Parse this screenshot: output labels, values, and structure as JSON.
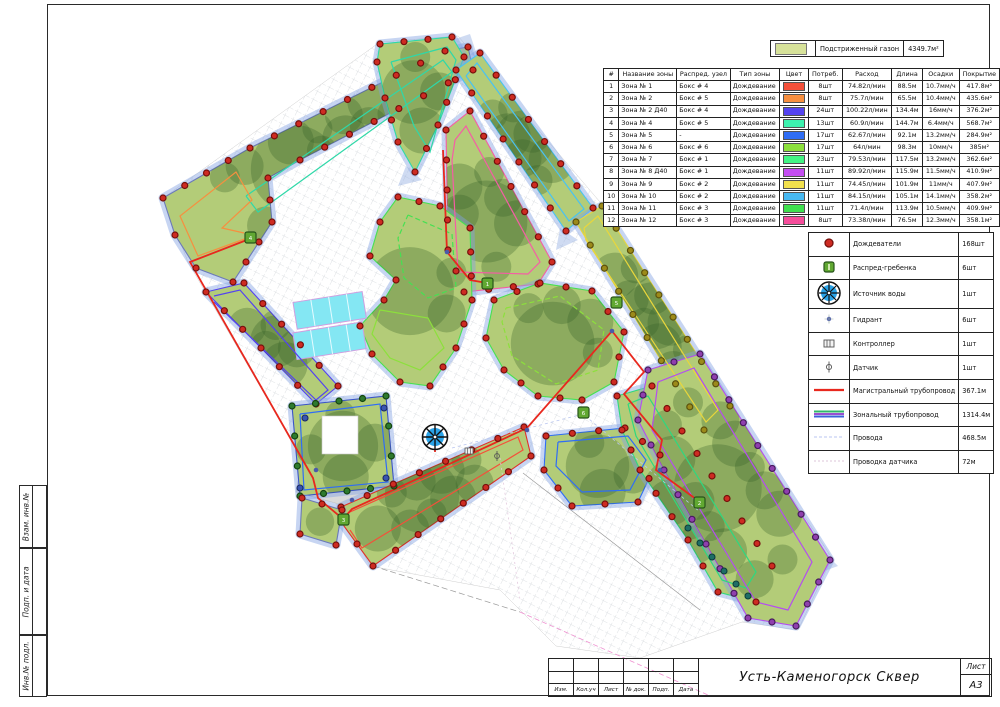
{
  "page": {
    "drawing_title": "Усть-Каменогорск Сквер",
    "sheet_label": "Лист",
    "sheet_format": "А3"
  },
  "stamp_columns": [
    "Изм.",
    "Кол.уч",
    "Лист",
    "№ док.",
    "Подп.",
    "Дата"
  ],
  "side_labels": [
    "Взам. инв.№",
    "Подп. и дата",
    "Инв.№ подл."
  ],
  "lawn_legend": {
    "label": "Подстриженный газон",
    "value": "4349.7м²",
    "color": "#d7e29a"
  },
  "zones_table": {
    "headers": [
      "#",
      "Название зоны",
      "Распред. узел",
      "Тип зоны",
      "Цвет",
      "Потреб.",
      "Расход",
      "Длина",
      "Осадки",
      "Покрытие"
    ],
    "rows": [
      [
        "1",
        "Зона № 1",
        "Бокс # 4",
        "Дождевание",
        "#f4503a",
        "8шт",
        "74.82л/мин",
        "88.5м",
        "10.7мм/ч",
        "417.8м²"
      ],
      [
        "2",
        "Зона № 2",
        "Бокс # 5",
        "Дождевание",
        "#f78f3f",
        "8шт",
        "75.7л/мин",
        "65.5м",
        "10.4мм/ч",
        "435.6м²"
      ],
      [
        "3",
        "Зона № 2 Д40",
        "Бокс # 4",
        "Дождевание",
        "#5443f0",
        "24шт",
        "100.22л/мин",
        "134.4м",
        "16мм/ч",
        "376.2м²"
      ],
      [
        "4",
        "Зона № 4",
        "Бокс # 5",
        "Дождевание",
        "#3df2af",
        "13шт",
        "60.9л/мин",
        "144.7м",
        "6.4мм/ч",
        "568.7м²"
      ],
      [
        "5",
        "Зона № 5",
        "-",
        "Дождевание",
        "#2f6df5",
        "17шт",
        "62.67л/мин",
        "92.1м",
        "13.2мм/ч",
        "284.9м²"
      ],
      [
        "6",
        "Зона № 6",
        "Бокс # 6",
        "Дождевание",
        "#8ce03c",
        "17шт",
        "64л/мин",
        "98.3м",
        "10мм/ч",
        "385м²"
      ],
      [
        "7",
        "Зона № 7",
        "Бокс # 1",
        "Дождевание",
        "#42f584",
        "23шт",
        "79.53л/мин",
        "117.5м",
        "13.2мм/ч",
        "362.6м²"
      ],
      [
        "8",
        "Зона № 8 Д40",
        "Бокс # 1",
        "Дождевание",
        "#c44df2",
        "11шт",
        "89.92л/мин",
        "115.9м",
        "11.5мм/ч",
        "410.9м²"
      ],
      [
        "9",
        "Зона № 9",
        "Бокс # 2",
        "Дождевание",
        "#f2e14d",
        "11шт",
        "74.45л/мин",
        "101.9м",
        "11мм/ч",
        "407.9м²"
      ],
      [
        "10",
        "Зона № 10",
        "Бокс # 2",
        "Дождевание",
        "#47b9f2",
        "11шт",
        "84.15л/мин",
        "105.1м",
        "14.1мм/ч",
        "358.2м²"
      ],
      [
        "11",
        "Зона № 11",
        "Бокс # 3",
        "Дождевание",
        "#3fe04e",
        "11шт",
        "71.4л/мин",
        "113.9м",
        "10.5мм/ч",
        "409.9м²"
      ],
      [
        "12",
        "Зона № 12",
        "Бокс # 3",
        "Дождевание",
        "#f54d9b",
        "8шт",
        "73.38л/мин",
        "76.5м",
        "12.3мм/ч",
        "358.1м²"
      ]
    ]
  },
  "equipment_legend": {
    "rows": [
      {
        "icon": "sprinkler-icon",
        "label": "Дождеватели",
        "value": "168шт"
      },
      {
        "icon": "manifold-icon",
        "label": "Распред-гребенка",
        "value": "6шт"
      },
      {
        "icon": "water-source-icon",
        "label": "Источник воды",
        "value": "1шт"
      },
      {
        "icon": "hydrant-icon",
        "label": "Гидрант",
        "value": "6шт"
      },
      {
        "icon": "controller-icon",
        "label": "Контроллер",
        "value": "1шт"
      },
      {
        "icon": "sensor-icon",
        "label": "Датчик",
        "value": "1шт"
      },
      {
        "icon": "main-pipe-icon",
        "label": "Магистральный трубопровод",
        "value": "367.1м"
      },
      {
        "icon": "zone-pipe-icon",
        "label": "Зональный трубопровод",
        "value": "1314.4м"
      },
      {
        "icon": "wires-icon",
        "label": "Провода",
        "value": "468.5м"
      },
      {
        "icon": "sensor-wire-icon",
        "label": "Проводка датчика",
        "value": "72м"
      }
    ]
  },
  "colors": {
    "main_pipe": "#e8281e",
    "lawn_base": "#b3cc78",
    "canopy": "rgba(52,96,40,0.30)",
    "spray_halo": "rgba(130,162,226,0.45)",
    "hatch": "#d6dade",
    "water_source_blue": "#2aa3e8",
    "sprinkler_dot": "#ce2b22"
  }
}
